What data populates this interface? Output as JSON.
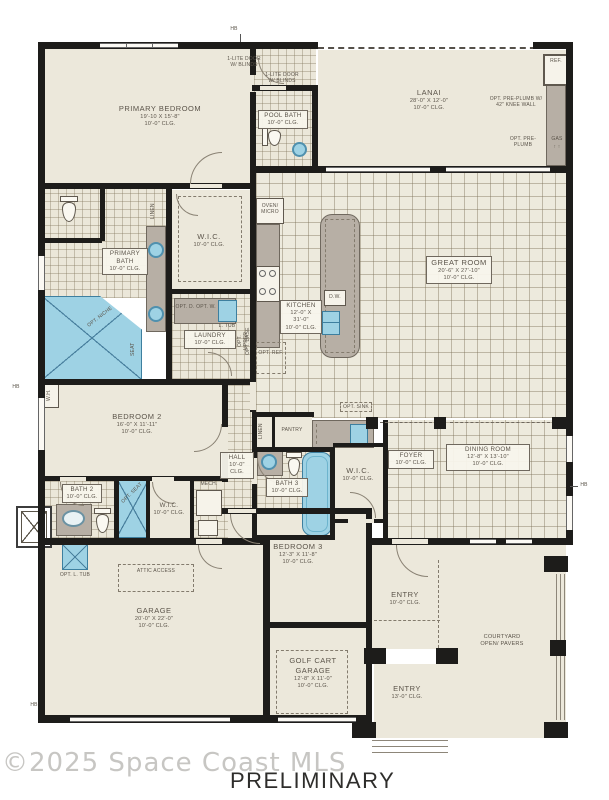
{
  "footer": {
    "watermark": "©2025 Space Coast MLS",
    "status": "PRELIMINARY"
  },
  "rooms": {
    "primary_bedroom": {
      "name": "PRIMARY BEDROOM",
      "dims": "19'-10 X 15'-8\"",
      "clg": "10'-0\" CLG."
    },
    "pool_bath": {
      "name": "POOL BATH",
      "clg": "10'-0\" CLG."
    },
    "lanai": {
      "name": "LANAI",
      "dims": "28'-0\" X 12'-0\"",
      "clg": "10'-0\" CLG."
    },
    "great_room": {
      "name": "GREAT ROOM",
      "dims": "20'-6\" X 27'-10\"",
      "clg": "10'-0\" CLG."
    },
    "kitchen": {
      "name": "KITCHEN",
      "dims": "12'-0\" X 31'-0\"",
      "clg": "10'-0\" CLG."
    },
    "primary_bath": {
      "name": "PRIMARY BATH",
      "clg": "10'-0\" CLG."
    },
    "wic_primary": {
      "name": "W.I.C.",
      "clg": "10'-0\" CLG."
    },
    "laundry": {
      "name": "LAUNDRY",
      "clg": "10'-0\" CLG."
    },
    "bedroom_2": {
      "name": "BEDROOM 2",
      "dims": "16'-0\" X 11'-11\"",
      "clg": "10'-0\" CLG."
    },
    "bath_2": {
      "name": "BATH 2",
      "clg": "10'-0\" CLG."
    },
    "wic_bedroom2": {
      "name": "W.I.C.",
      "clg": "10'-0\" CLG."
    },
    "hall": {
      "name": "HALL",
      "clg": "10'-0\" CLG."
    },
    "bath_3": {
      "name": "BATH 3",
      "clg": "10'-0\" CLG."
    },
    "wic_bedroom3": {
      "name": "W.I.C.",
      "clg": "10'-0\" CLG."
    },
    "foyer": {
      "name": "FOYER",
      "clg": "10'-0\" CLG."
    },
    "dining_room": {
      "name": "DINING ROOM",
      "dims": "12'-8\" X 13'-10\"",
      "clg": "10'-0\" CLG."
    },
    "bedroom_3": {
      "name": "BEDROOM 3",
      "dims": "12'-3\" X 11'-8\"",
      "clg": "10'-0\" CLG."
    },
    "garage": {
      "name": "GARAGE",
      "dims": "20'-0\" X 22'-0\"",
      "clg": "10'-0\" CLG."
    },
    "golf_cart_garage": {
      "name": "GOLF CART GARAGE",
      "dims": "12'-8\" X 11'-0\"",
      "clg": "10'-0\" CLG."
    },
    "entry_rear": {
      "name": "ENTRY",
      "clg": "10'-0\" CLG."
    },
    "entry_front": {
      "name": "ENTRY",
      "clg": "13'-0\" CLG."
    },
    "courtyard": {
      "name": "COURTYARD",
      "sub": "OPEN/ PAVERS"
    }
  },
  "annotations": {
    "hb": "HB",
    "wh": "W.H.",
    "ref": "REF.",
    "gas": "GAS",
    "gas_arrows": "↑ ↑",
    "opt_preplumb_knee_wall": "OPT. PRE-PLUMB W/ 42\" KNEE WALL",
    "opt_preplumb": "OPT. PRE-PLUMB",
    "lite_door_blinds": "1-LITE DOOR W/ BLINDS",
    "linen": "LINEN",
    "oven_micro": "OVEN/ MICRO",
    "dw": "D.W.",
    "opt_ref": "OPT. REF.",
    "opt_d": "OPT. D.",
    "opt_w": "OPT. W.",
    "l_tub": "L. TUB",
    "opt_upper": "OPT. UPPER",
    "opt_base": "OPT. BASE",
    "seat": "SEAT",
    "opt_niche": "OPT. NICHE",
    "opt_sink": "OPT. SINK",
    "pantry": "PANTRY",
    "mech": "MECH.",
    "opt_seat": "OPT. SEAT",
    "opt_l_tub": "OPT. L. TUB",
    "attic_access": "ATTIC ACCESS"
  },
  "colors": {
    "wall": "#1d1c1a",
    "floor": "#ece8db",
    "tile_line": "#8a7e64",
    "counter": "#b7afa5",
    "fixture_blue": "#9ed2e4",
    "text": "#5b544a",
    "watermark": "#c7c6c3",
    "status_text": "#2e2d2b"
  }
}
